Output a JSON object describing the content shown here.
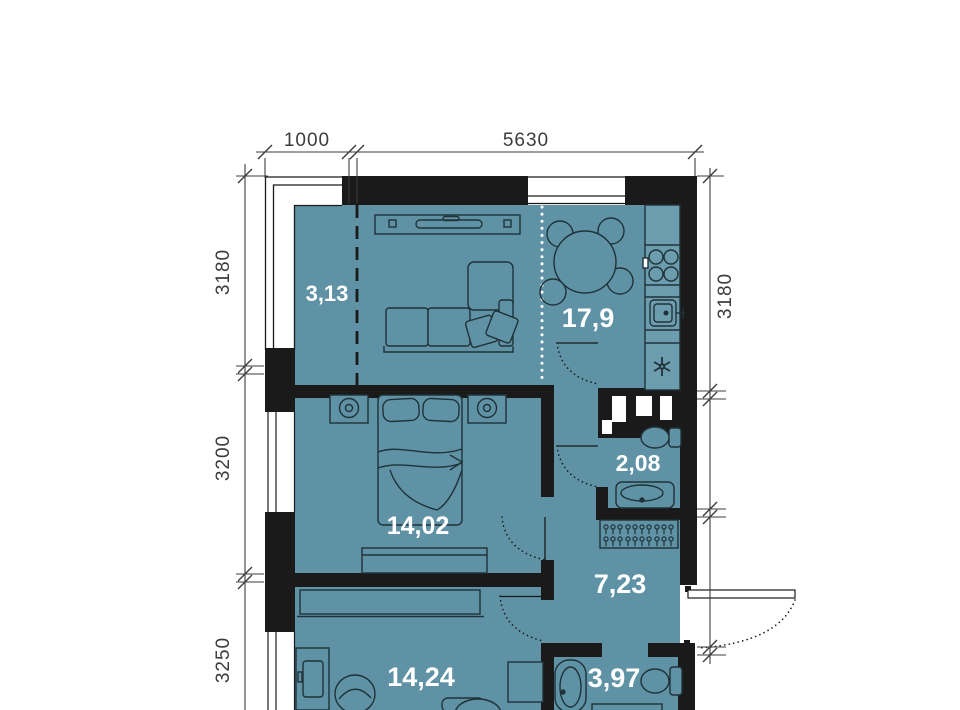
{
  "plan": {
    "title": "apartment-floor-plan",
    "colors": {
      "floor_fill": "#5E92A4",
      "counter_fill": "#6C9DAE",
      "wall": "#1A1A1A",
      "furniture_outline": "#203238",
      "dimension": "#3C3C3C",
      "label_text": "#FFFFFF"
    },
    "dimensions": {
      "top": [
        "1000",
        "5630"
      ],
      "left": [
        "3180",
        "3200",
        "3250"
      ],
      "right": [
        "3180"
      ]
    },
    "rooms": [
      {
        "id": "balcony",
        "area": "3,13"
      },
      {
        "id": "kitchen-living",
        "area": "17,9"
      },
      {
        "id": "bedroom",
        "area": "14,02"
      },
      {
        "id": "bathroom-guest",
        "area": "2,08"
      },
      {
        "id": "hallway",
        "area": "7,23"
      },
      {
        "id": "room-second",
        "area": "14,24"
      },
      {
        "id": "bathroom-main",
        "area": "3,97"
      }
    ],
    "icons": [
      "tv-console-icon",
      "sofa-icon",
      "dining-table-icon",
      "stove-icon",
      "kitchen-sink-icon",
      "fridge-snowflake-icon",
      "bed-icon",
      "nightstand-lamp-icon",
      "dresser-icon",
      "toilet-icon",
      "washbasin-icon",
      "coat-rack-icon",
      "wardrobe-icon",
      "desk-icon",
      "office-chair-icon",
      "washing-machine-icon",
      "pedestal-sink-icon",
      "armchair-icon",
      "bathtub-icon",
      "door-swing-icon",
      "window",
      "wall"
    ]
  }
}
